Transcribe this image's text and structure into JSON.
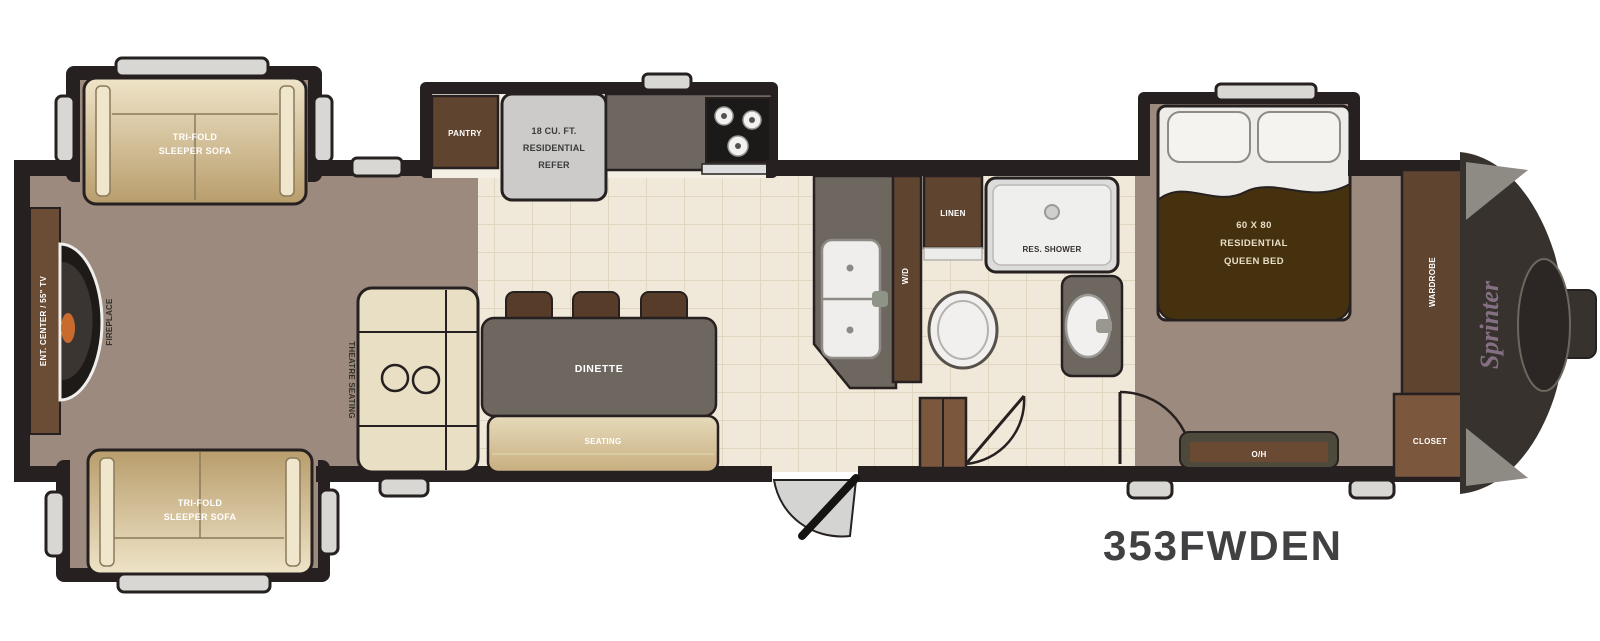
{
  "model": "353FWDEN",
  "brand": "Sprinter",
  "labels": {
    "sofa_top": {
      "line1": "TRI-FOLD",
      "line2": "SLEEPER SOFA"
    },
    "sofa_bottom": {
      "line1": "TRI-FOLD",
      "line2": "SLEEPER SOFA"
    },
    "ent_center": "ENT. CENTER / 55\" TV",
    "fireplace": "FIREPLACE",
    "theatre_seating": "THEATRE SEATING",
    "pantry": "PANTRY",
    "refer": {
      "line1": "18 CU. FT.",
      "line2": "RESIDENTIAL",
      "line3": "REFER"
    },
    "dinette": "DINETTE",
    "seating": "SEATING",
    "wd": "W/D",
    "linen": "LINEN",
    "shower": "RES. SHOWER",
    "bed": {
      "line1": "60 X 80",
      "line2": "RESIDENTIAL",
      "line3": "QUEEN BED"
    },
    "wardrobe": "WARDROBE",
    "closet": "CLOSET",
    "overhead": "O/H"
  },
  "colors": {
    "wall": "#262120",
    "carpet": "#9b8a7d",
    "tile": "#f0e8d8",
    "cabinet_brown": "#5f4430",
    "cabinet_light_brown": "#7b573d",
    "counter_gray": "#6d6760",
    "sofa_tan": "#d9c49a",
    "bed_blanket_brown": "#46310f",
    "front_cap_dark": "#37322e",
    "window_gray": "#d8d7d4",
    "model_text": "#414042",
    "flame_orange": "#c96a2e"
  }
}
